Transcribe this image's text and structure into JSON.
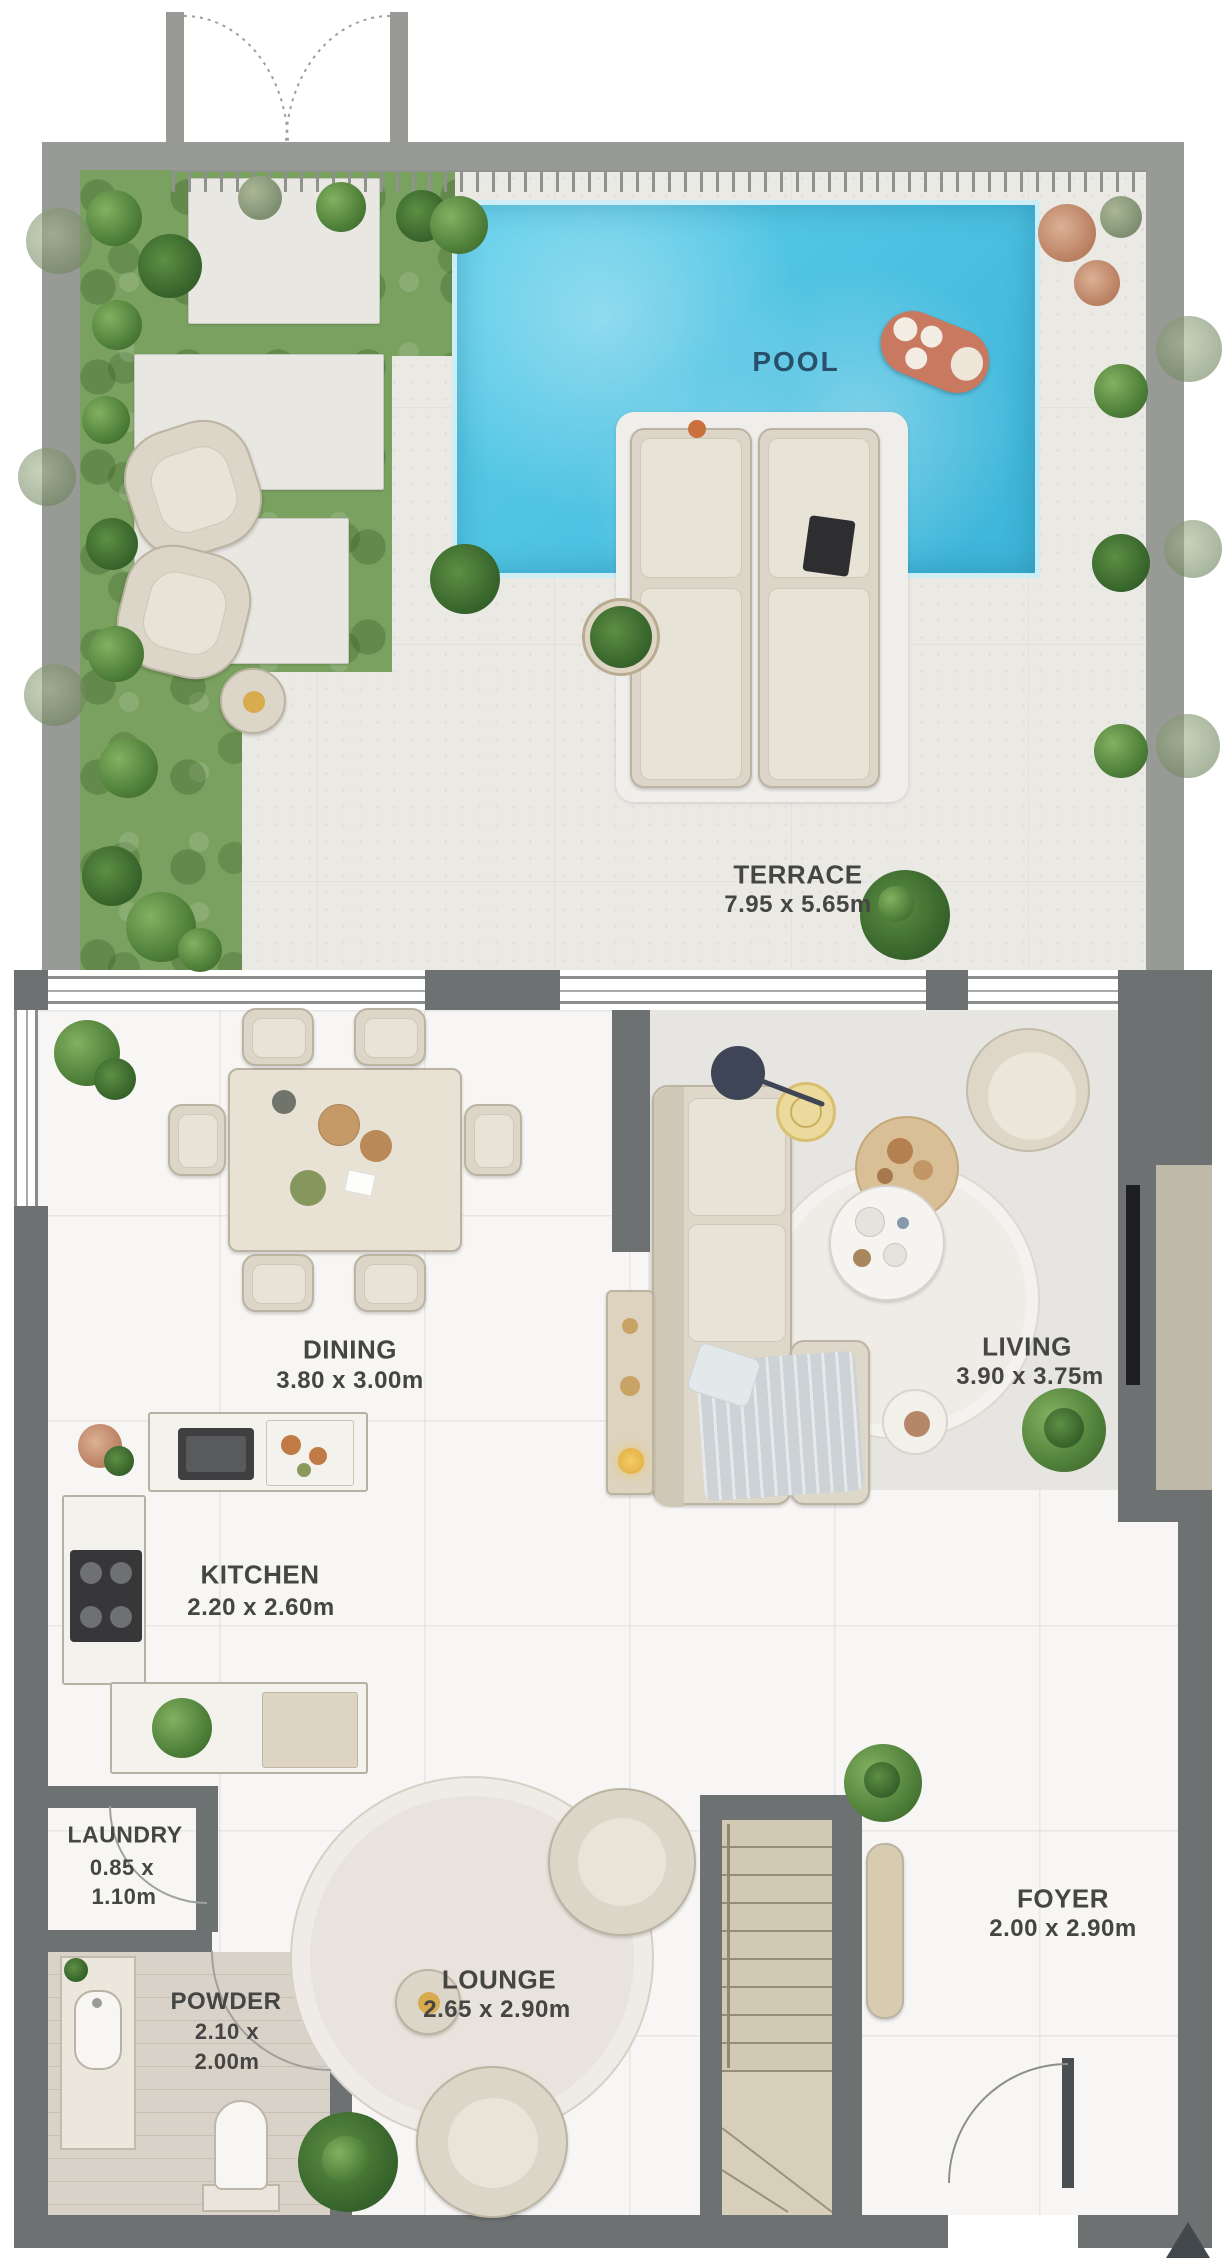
{
  "plan_title": "Townhouse ground floor plan with terrace and pool",
  "labels": {
    "pool": {
      "name": "POOL"
    },
    "terrace": {
      "name": "TERRACE",
      "dims": "7.95 x 5.65m"
    },
    "dining": {
      "name": "DINING",
      "dims": "3.80 x 3.00m"
    },
    "living": {
      "name": "LIVING",
      "dims": "3.90 x 3.75m"
    },
    "kitchen": {
      "name": "KITCHEN",
      "dims": "2.20 x 2.60m"
    },
    "laundry": {
      "name": "LAUNDRY",
      "dims_line1": "0.85 x",
      "dims_line2": "1.10m"
    },
    "powder": {
      "name": "POWDER",
      "dims_line1": "2.10 x",
      "dims_line2": "2.00m"
    },
    "lounge": {
      "name": "LOUNGE",
      "dims": "2.65 x 2.90m"
    },
    "foyer": {
      "name": "FOYER",
      "dims": "2.00 x 2.90m"
    }
  },
  "colors": {
    "wall_interior": "#6d7172",
    "wall_terrace": "#979a95",
    "garden_green": "#7aa15f",
    "floor_terrace": "#ebe9e4",
    "floor_interior": "#f7f6f4",
    "living_floor": "#e7e5e1",
    "pool_1": "#5ecfeb",
    "pool_2": "#3cb4d8",
    "pool_coping": "#cdeef7",
    "furniture": "#dcd6c8",
    "stairs": "#d2c9b2",
    "label": "#454543",
    "pool_label": "#29506b",
    "accent_yellow": "#d8ab4e",
    "lilo": "#c8795f"
  }
}
